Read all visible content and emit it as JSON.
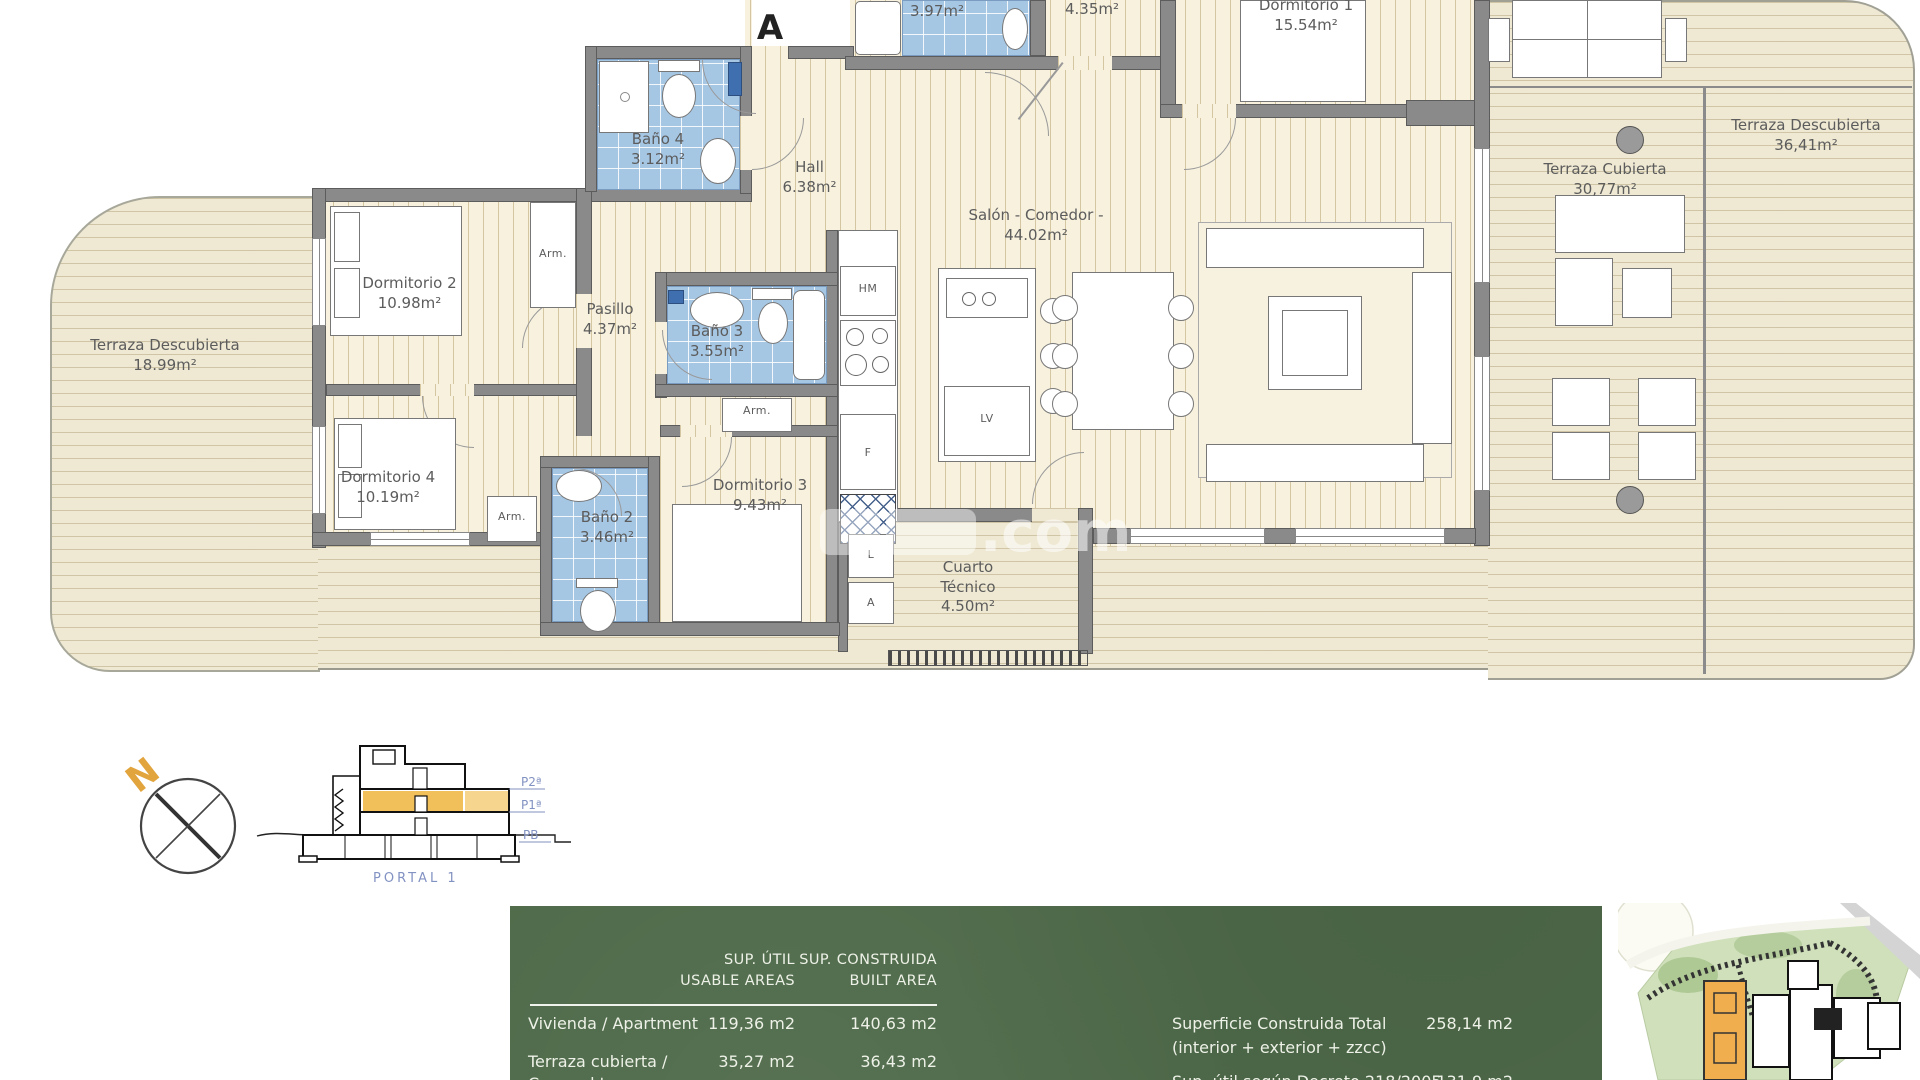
{
  "plan": {
    "entrance_label": "A",
    "watermark": ".com",
    "closet_label": "Arm.",
    "rooms": {
      "terraza_izq": {
        "name": "Terraza Descubierta",
        "area": "18.99m²"
      },
      "dormitorio2": {
        "name": "Dormitorio 2",
        "area": "10.98m²"
      },
      "dormitorio4": {
        "name": "Dormitorio 4",
        "area": "10.19m²"
      },
      "bano4": {
        "name": "Baño 4",
        "area": "3.12m²"
      },
      "hall": {
        "name": "Hall",
        "area": "6.38m²"
      },
      "bano_top": {
        "area": "3.97m²"
      },
      "room_435": {
        "area": "4.35m²"
      },
      "dormitorio1": {
        "name": "Dormitorio 1",
        "area": "15.54m²"
      },
      "salon": {
        "name": "Salón - Comedor -",
        "area": "44.02m²"
      },
      "pasillo": {
        "name": "Pasillo",
        "area": "4.37m²"
      },
      "bano3": {
        "name": "Baño 3",
        "area": "3.55m²"
      },
      "bano2": {
        "name": "Baño 2",
        "area": "3.46m²"
      },
      "dormitorio3": {
        "name": "Dormitorio 3",
        "area": "9.43m²"
      },
      "cuarto_tecnico": {
        "name_line1": "Cuarto",
        "name_line2": "Técnico",
        "area": "4.50m²"
      },
      "terraza_cubierta": {
        "name": "Terraza Cubierta",
        "area": "30,77m²"
      },
      "terraza_der": {
        "name": "Terraza Descubierta",
        "area": "36,41m²"
      }
    },
    "appliances": {
      "hm": "HM",
      "f": "F",
      "lv": "LV",
      "l": "L",
      "a": "A"
    }
  },
  "compass": {
    "north_label": "N"
  },
  "section": {
    "portal": "PORTAL 1",
    "floors": [
      "P2ª",
      "P1ª",
      "PB"
    ]
  },
  "table": {
    "col1_header_line1": "SUP. ÚTIL",
    "col1_header_line2": "USABLE AREAS",
    "col2_header_line1": "SUP. CONSTRUIDA",
    "col2_header_line2": "BUILT AREA",
    "rows": [
      {
        "label": "Vivienda / Apartment",
        "label2": "",
        "util": "119,36 m2",
        "construida": "140,63 m2"
      },
      {
        "label": "Terraza cubierta /",
        "label2": "Covered terrace",
        "util": "35,27 m2",
        "construida": "36,43 m2"
      }
    ],
    "total_label_line1": "Superficie Construida Total",
    "total_label_line2": "(interior + exterior + zzcc)",
    "total_value": "258,14 m2",
    "decreto_label": "Sup. útil según Decreto 218/2005",
    "decreto_value": "131,9 m2"
  },
  "colors": {
    "tile_blue": "#a6c7e4",
    "table_green": "#4e6a49",
    "highlight_orange": "#f2c05a",
    "north_orange": "#e2a43c"
  }
}
